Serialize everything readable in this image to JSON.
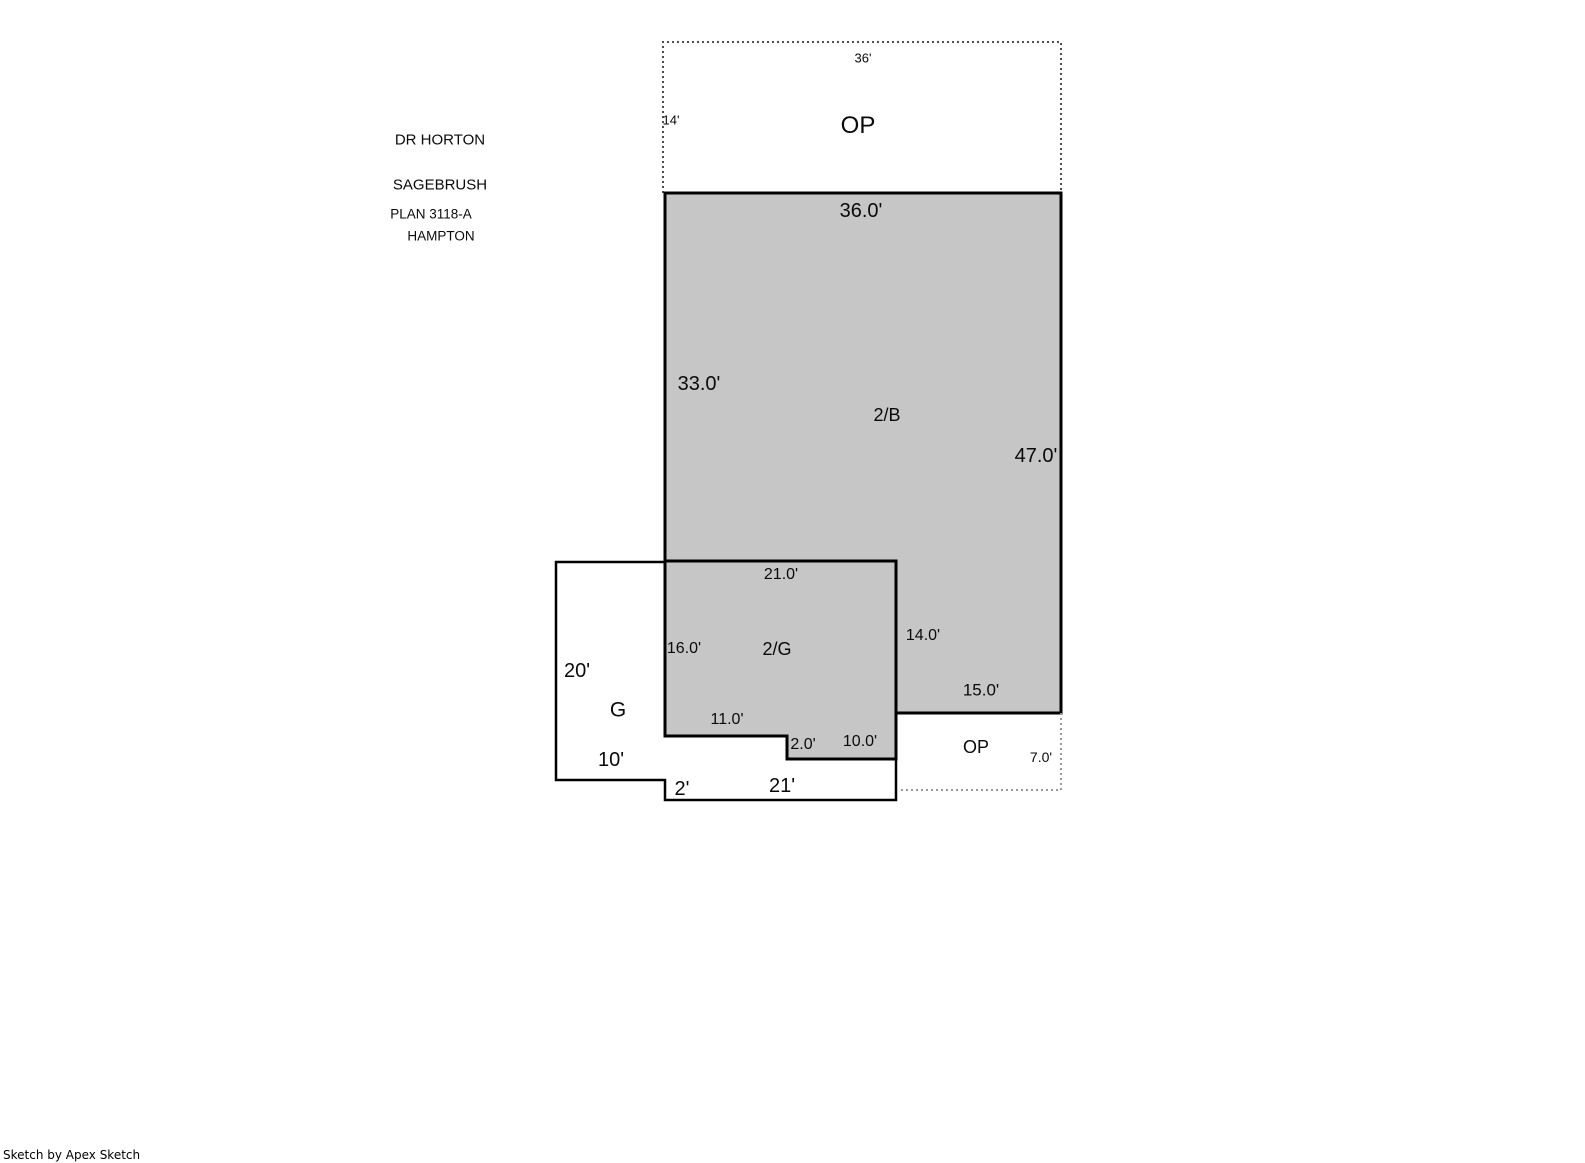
{
  "header": {
    "brand": "DR HORTON",
    "model": "SAGEBRUSH",
    "plan": "PLAN 3118-A",
    "elevation": "HAMPTON"
  },
  "areas": {
    "op_top": {
      "label": "OP",
      "dim_top": "36'",
      "dim_left": "14'"
    },
    "floor2": {
      "label": "2/B",
      "dim_top": "36.0'",
      "dim_left": "33.0'",
      "dim_right": "47.0'",
      "dim_bottom": "15.0'"
    },
    "garage2": {
      "label": "2/G",
      "dim_top": "21.0'",
      "dim_left": "16.0'",
      "dim_right": "14.0'",
      "dim_bottom": "11.0'",
      "dim_step": "2.0'",
      "dim_bottom_right": "10.0'"
    },
    "garage": {
      "label": "G",
      "dim_left": "20'",
      "dim_bottom": "10'",
      "dim_step": "2'",
      "dim_porch": "21'"
    },
    "op_bottom": {
      "label": "OP",
      "dim_right": "7.0'"
    }
  },
  "colors": {
    "area_fill": "#c6c6c6",
    "outline": "#000000",
    "dotted_dark": "#4d4d4d",
    "dotted_light": "#999999"
  },
  "footer": {
    "credit": "Sketch by Apex Sketch"
  }
}
